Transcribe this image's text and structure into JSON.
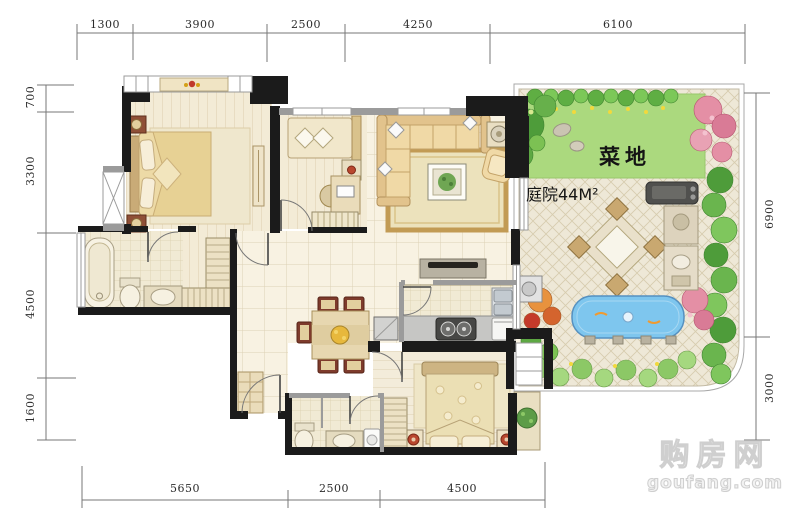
{
  "dimensions": {
    "top": [
      "1300",
      "3900",
      "2500",
      "4250",
      "6100"
    ],
    "left": [
      "700",
      "3300",
      "4500",
      "1600"
    ],
    "right": [
      "6900",
      "3000"
    ],
    "bottom": [
      "5650",
      "2500",
      "4500"
    ]
  },
  "garden": {
    "vegetable_plot_label": "菜地",
    "courtyard_label": "庭院44M²"
  },
  "watermark": {
    "site_name": "购房网",
    "site_url": "goufang.com"
  },
  "colors": {
    "wall": "#1b1b1b",
    "floor_cream": "#f8f2e2",
    "wood_floor": "#f3ebd6",
    "lawn_green": "#abd97e",
    "hedge_green": "#4e9c3a",
    "flower_pink": "#e48fa5",
    "pool_blue": "#7ec6ee",
    "paving": "#eee8d7",
    "furniture_beige": "#f0d9a6"
  }
}
